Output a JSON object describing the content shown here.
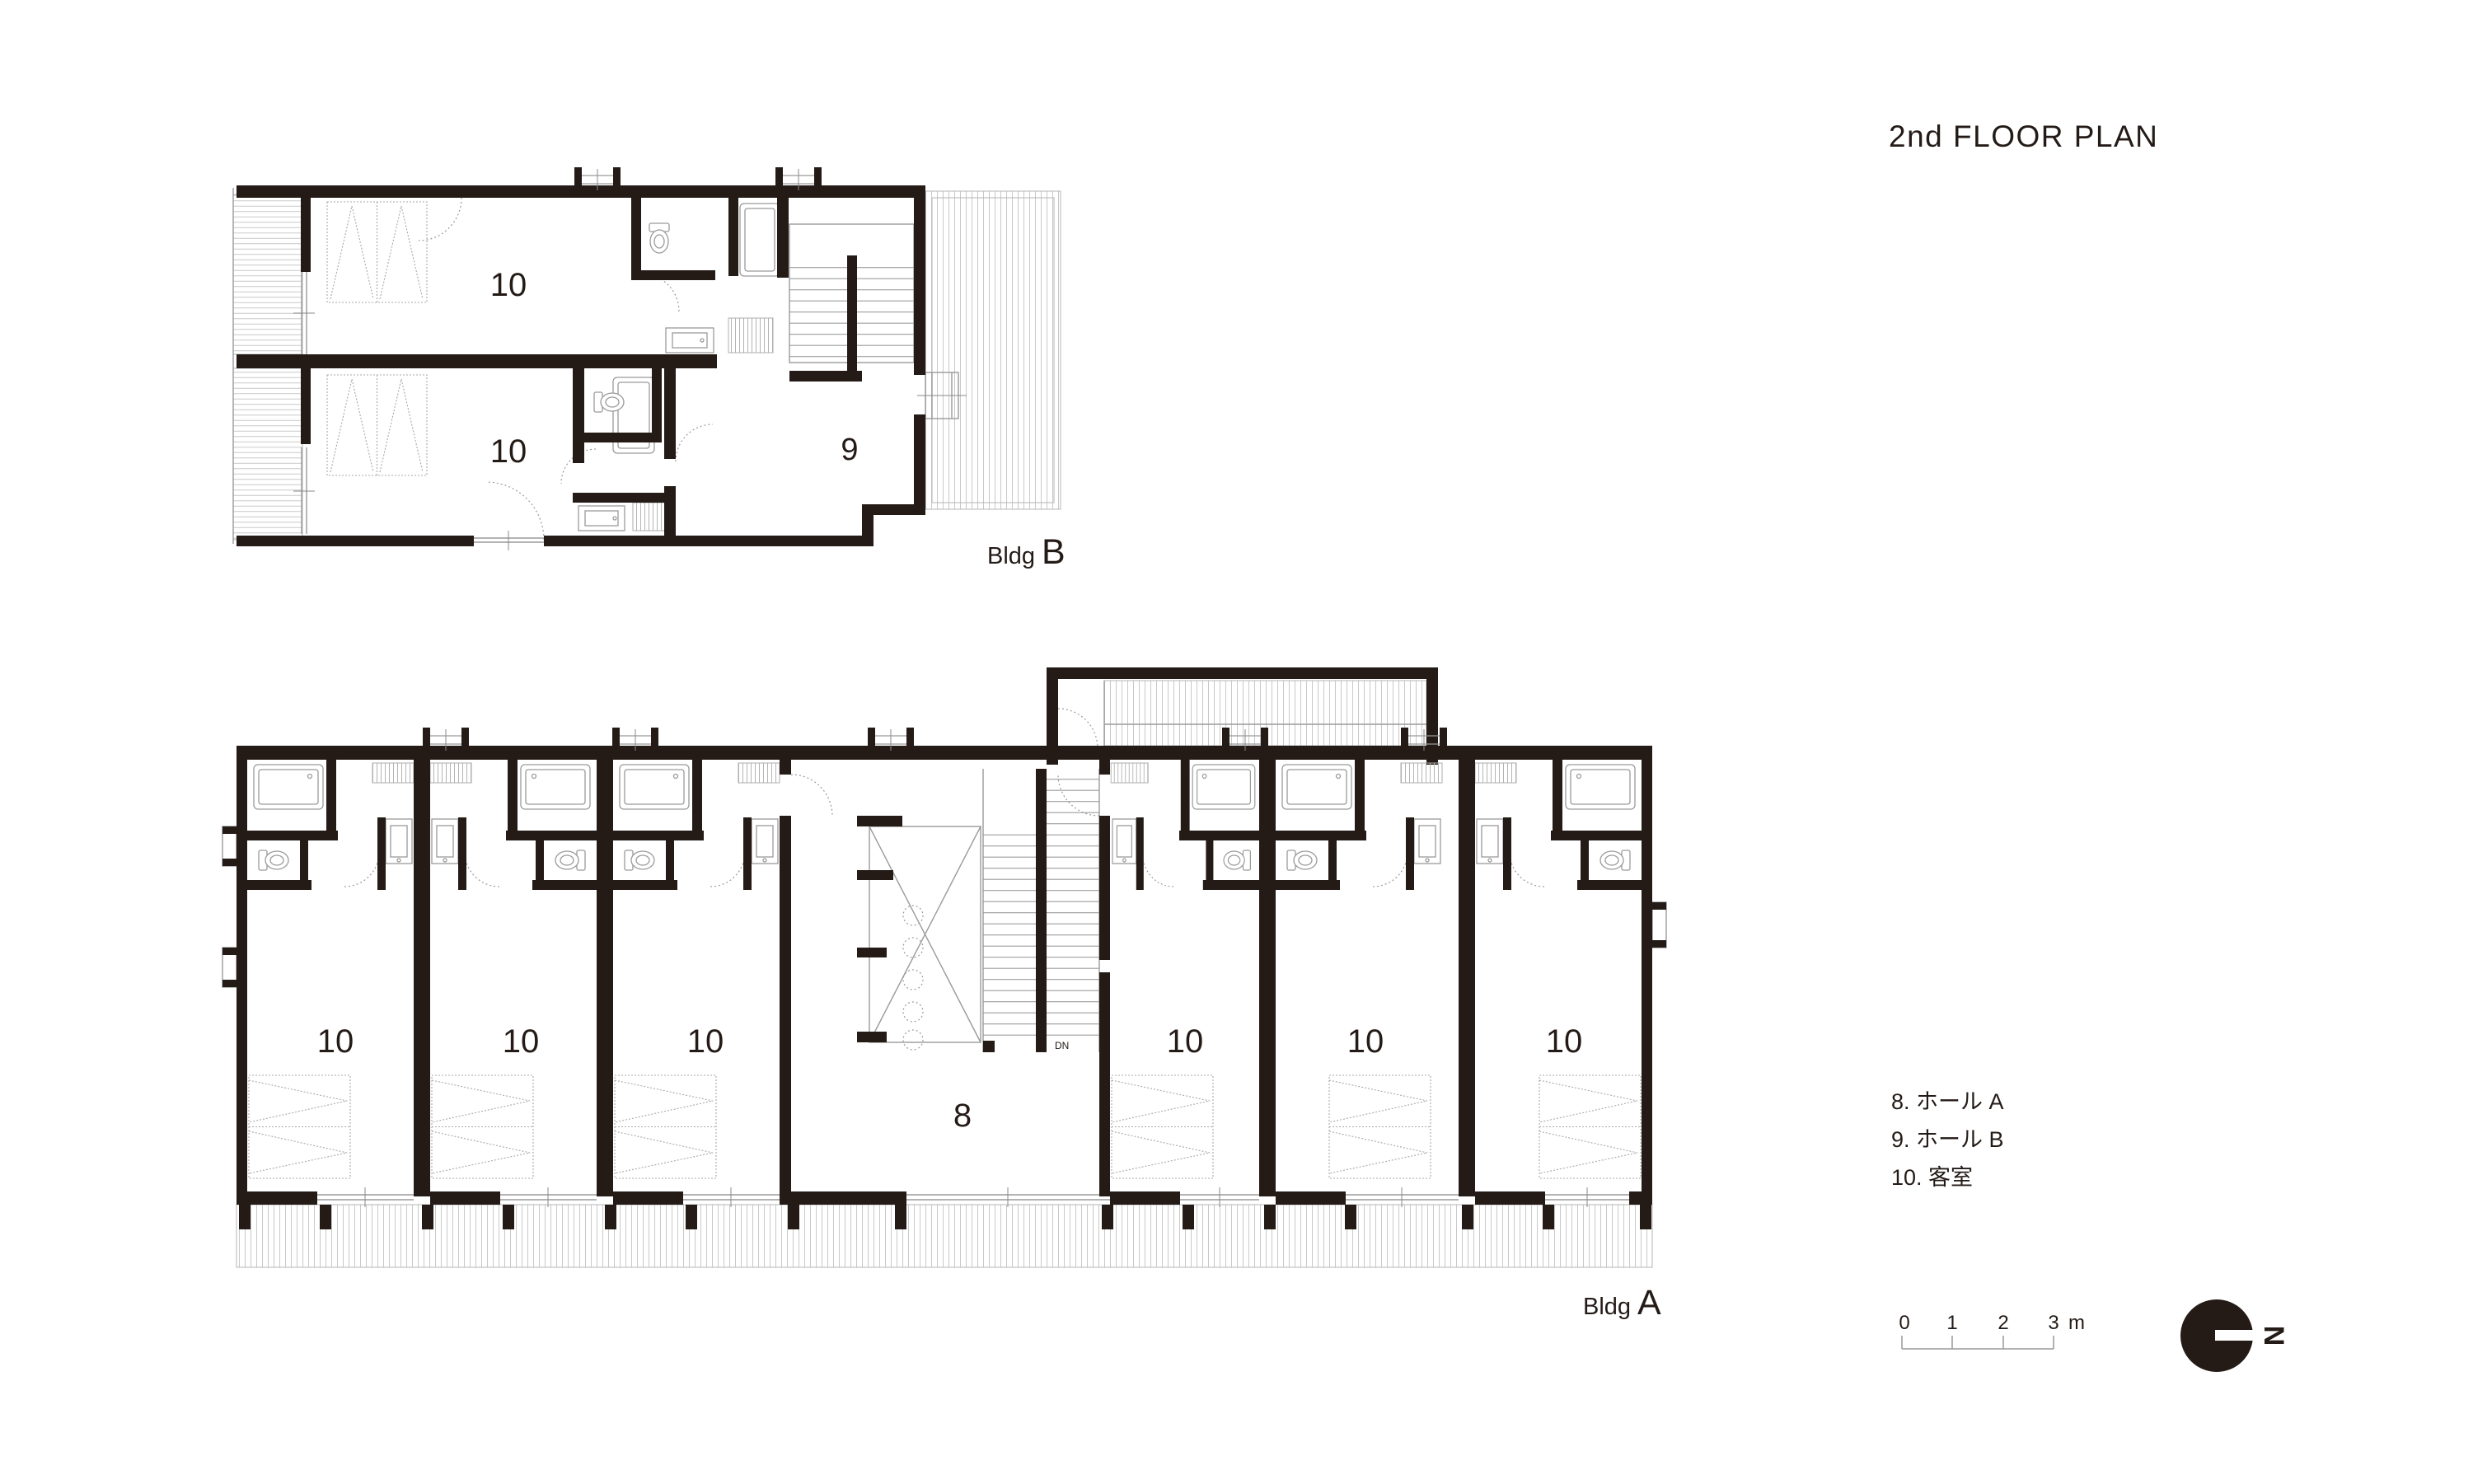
{
  "title": "2nd FLOOR PLAN",
  "bldg_b": {
    "word": "Bldg",
    "letter": "B",
    "room_labels": [
      "10",
      "10"
    ],
    "hall_label": "9"
  },
  "bldg_a": {
    "word": "Bldg",
    "letter": "A",
    "room_labels": [
      "10",
      "10",
      "10",
      "10",
      "10",
      "10"
    ],
    "hall_label": "8",
    "stair_note": "DN"
  },
  "legend": {
    "items": [
      "8. ホール A",
      "9. ホール B",
      "10. 客室"
    ]
  },
  "scale_bar": {
    "ticks": [
      "0",
      "1",
      "2",
      "3"
    ],
    "unit": "m"
  },
  "compass": {
    "label": "N"
  },
  "colors": {
    "ink": "#241b17",
    "line": "#9a9a9a",
    "stripe": "#c9c9c9"
  }
}
